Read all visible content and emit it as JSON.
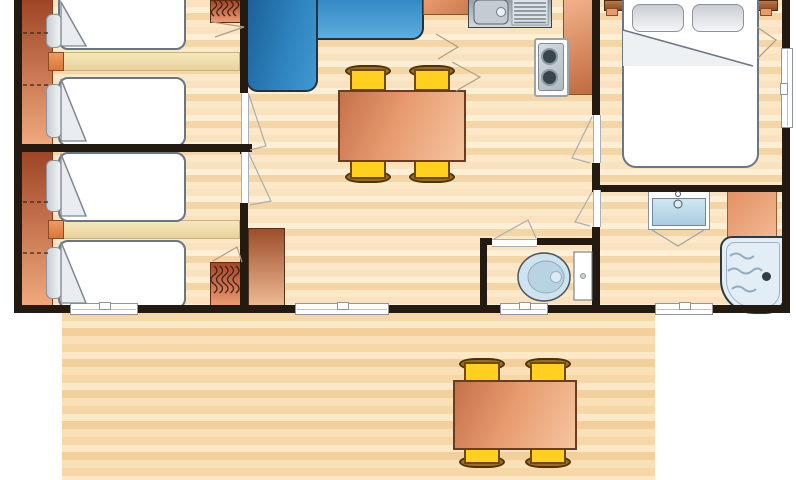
{
  "title": "Mobile home floor plan with two twin bedrooms, living-kitchen area, master bedroom, bathroom, WC and wooden terrace",
  "colors": {
    "wall": "#231a11",
    "floor_a": "#f9e2bd",
    "floor_b": "#fdeed6",
    "floor_c": "#f4d6a6",
    "floor_d": "#fbe8c8",
    "deck_a": "#f6d8a8",
    "deck_b": "#fbe8c6",
    "deck_c": "#f2cf9b",
    "deck_d": "#f9e0b6",
    "sofa_dark": "#1c5f98",
    "sofa_light": "#5eaede",
    "table_dark": "#c4714a",
    "table_light": "#f6c5a0",
    "chair_yellow": "#ffd020",
    "chair_brown": "#9c6b26",
    "hb_dark": "#9e4526",
    "hb_light": "#f0a87c",
    "ward_dark": "#a8442a",
    "ward_light": "#ec9d74",
    "bed_white": "#ffffff",
    "pillow_grey": "#d4d8de",
    "metal": "#aeb8bf",
    "fixture_blue": "#bcdcee",
    "tub": "#e2edf5",
    "window_grey": "#c6cccf"
  },
  "rooms": [
    {
      "id": "bedroom-twin-1",
      "furniture": [
        "headboard-shelf",
        "twin-bed",
        "twin-bed",
        "nightstand-shelf",
        "hanger-wardrobe",
        "door"
      ]
    },
    {
      "id": "bedroom-twin-2",
      "furniture": [
        "headboard-shelf",
        "twin-bed",
        "twin-bed",
        "nightstand-shelf",
        "hanger-wardrobe",
        "door",
        "window"
      ]
    },
    {
      "id": "living-room",
      "furniture": [
        "corner-sofa",
        "dining-table",
        "chair",
        "chair",
        "chair",
        "chair",
        "storage-cabinet",
        "sliding-window"
      ]
    },
    {
      "id": "kitchen",
      "furniture": [
        "sink-with-drainer",
        "two-burner-hob",
        "worktop",
        "worktop"
      ]
    },
    {
      "id": "master-bedroom",
      "furniture": [
        "double-bed",
        "pillow",
        "pillow",
        "headboard-shelf",
        "window",
        "door"
      ]
    },
    {
      "id": "bathroom",
      "furniture": [
        "washbasin",
        "bathtub",
        "shelf-unit",
        "window",
        "door"
      ]
    },
    {
      "id": "wc",
      "furniture": [
        "toilet",
        "window",
        "door"
      ]
    },
    {
      "id": "terrace",
      "furniture": [
        "outdoor-table",
        "chair",
        "chair",
        "chair",
        "chair"
      ]
    }
  ]
}
